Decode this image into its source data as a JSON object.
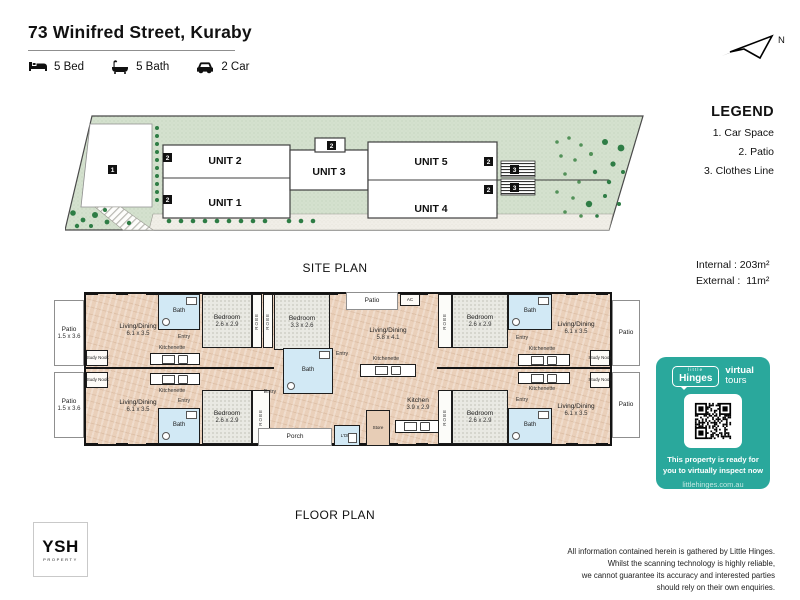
{
  "header": {
    "title": "73 Winifred Street, Kuraby",
    "features": [
      {
        "icon": "bed-icon",
        "label": "5 Bed"
      },
      {
        "icon": "bath-icon",
        "label": "5 Bath"
      },
      {
        "icon": "car-icon",
        "label": "2 Car"
      }
    ]
  },
  "compass": {
    "label": "N"
  },
  "legend": {
    "title": "LEGEND",
    "items": [
      "1. Car Space",
      "2. Patio",
      "3. Clothes Line"
    ]
  },
  "site_plan": {
    "caption": "SITE PLAN",
    "units": [
      {
        "name": "UNIT 2",
        "x": 160,
        "y": 52
      },
      {
        "name": "UNIT 1",
        "x": 160,
        "y": 94
      },
      {
        "name": "UNIT 3",
        "x": 264,
        "y": 63
      },
      {
        "name": "UNIT 5",
        "x": 366,
        "y": 53
      },
      {
        "name": "UNIT 4",
        "x": 366,
        "y": 100
      }
    ],
    "markers": [
      {
        "n": "1",
        "x": 43,
        "y": 53
      },
      {
        "n": "2",
        "x": 98,
        "y": 41
      },
      {
        "n": "2",
        "x": 98,
        "y": 83
      },
      {
        "n": "2",
        "x": 262,
        "y": 29
      },
      {
        "n": "2",
        "x": 419,
        "y": 45
      },
      {
        "n": "2",
        "x": 419,
        "y": 73
      },
      {
        "n": "3",
        "x": 445,
        "y": 53
      },
      {
        "n": "3",
        "x": 445,
        "y": 71
      }
    ]
  },
  "areas": {
    "lines": [
      "Internal : 203m²",
      "External :  11m²"
    ]
  },
  "floor_plan": {
    "caption": "FLOOR PLAN",
    "rooms": [
      {
        "id": "patio-top-left",
        "label": "Patio",
        "dims": "1.5 x 3.6",
        "type": "white",
        "x": 2,
        "y": 8,
        "w": 30,
        "h": 66
      },
      {
        "id": "patio-bottom-left",
        "label": "Patio",
        "dims": "1.5 x 3.6",
        "type": "white",
        "x": 2,
        "y": 80,
        "w": 30,
        "h": 66
      },
      {
        "id": "living-top-left",
        "label": "Living/Dining",
        "dims": "6.1 x 3.5",
        "type": "label",
        "lx": 86,
        "ly": 38
      },
      {
        "id": "living-bottom-left",
        "label": "Living/Dining",
        "dims": "6.1 x 3.5",
        "type": "label",
        "lx": 86,
        "ly": 114
      },
      {
        "id": "study-nook-top-left",
        "label": "Study Nook",
        "type": "nook",
        "x": 34,
        "y": 58,
        "w": 22,
        "h": 16
      },
      {
        "id": "study-nook-bottom-left",
        "label": "Study Nook",
        "type": "nook",
        "x": 34,
        "y": 80,
        "w": 22,
        "h": 16
      },
      {
        "id": "kitchenette-top-left",
        "label": "Kitchenette",
        "type": "label",
        "s": 1,
        "lx": 120,
        "ly": 56
      },
      {
        "id": "kitchenette-bottom-left",
        "label": "Kitchenette",
        "type": "label",
        "s": 1,
        "lx": 120,
        "ly": 99
      },
      {
        "id": "kitchenette-units-top-left",
        "type": "kitrow",
        "x": 98,
        "y": 61,
        "w": 50,
        "h": 12
      },
      {
        "id": "kitchenette-units-bottom-left",
        "type": "kitrow",
        "x": 98,
        "y": 81,
        "w": 50,
        "h": 12
      },
      {
        "id": "bath-top-left",
        "label": "Bath",
        "type": "bath",
        "x": 106,
        "y": 2,
        "w": 42,
        "h": 36
      },
      {
        "id": "bath-bottom-left",
        "label": "Bath",
        "type": "bath",
        "x": 106,
        "y": 116,
        "w": 42,
        "h": 36
      },
      {
        "id": "entry-top-left",
        "label": "Entry",
        "type": "label",
        "s": 1,
        "lx": 132,
        "ly": 45
      },
      {
        "id": "entry-bottom-left",
        "label": "Entry",
        "type": "label",
        "s": 1,
        "lx": 132,
        "ly": 109
      },
      {
        "id": "bedroom-top-left",
        "label": "Bedroom",
        "dims": "2.6 x 2.9",
        "type": "carpet",
        "x": 150,
        "y": 2,
        "w": 50,
        "h": 54
      },
      {
        "id": "bedroom-bottom-left",
        "label": "Bedroom",
        "dims": "2.6 x 2.9",
        "type": "carpet",
        "x": 150,
        "y": 98,
        "w": 50,
        "h": 54
      },
      {
        "id": "robe-1-top-left",
        "label": "ROBE",
        "type": "robe",
        "x": 200,
        "y": 2,
        "w": 10,
        "h": 54
      },
      {
        "id": "robe-2-top-left",
        "label": "ROBE",
        "type": "robe",
        "x": 211,
        "y": 2,
        "w": 10,
        "h": 54
      },
      {
        "id": "robe-bottom-left",
        "label": "ROBE",
        "type": "robe",
        "x": 200,
        "y": 98,
        "w": 18,
        "h": 54
      },
      {
        "id": "bedroom-top-middle",
        "label": "Bedroom",
        "dims": "3.3 x 2.6",
        "type": "carpet",
        "x": 222,
        "y": 2,
        "w": 56,
        "h": 56
      },
      {
        "id": "bath-middle",
        "label": "Bath",
        "type": "bath",
        "x": 231,
        "y": 56,
        "w": 50,
        "h": 46
      },
      {
        "id": "entry-middle-top",
        "label": "Entry",
        "type": "label",
        "s": 1,
        "lx": 290,
        "ly": 62
      },
      {
        "id": "entry-middle-bottom",
        "label": "Entry",
        "type": "label",
        "s": 1,
        "lx": 218,
        "ly": 100
      },
      {
        "id": "porch",
        "label": "Porch",
        "type": "white",
        "x": 206,
        "y": 136,
        "w": 74,
        "h": 18
      },
      {
        "id": "laundry",
        "label": "L'DRY",
        "type": "bathsm",
        "x": 282,
        "y": 133,
        "w": 26,
        "h": 21
      },
      {
        "id": "store",
        "label": "Store",
        "type": "store",
        "x": 314,
        "y": 118,
        "w": 24,
        "h": 36
      },
      {
        "id": "patio-middle",
        "label": "Patio",
        "type": "white",
        "x": 294,
        "y": 0,
        "w": 52,
        "h": 18
      },
      {
        "id": "ac-unit",
        "label": "AC",
        "type": "nook",
        "x": 348,
        "y": 2,
        "w": 20,
        "h": 12
      },
      {
        "id": "living-middle",
        "label": "Living/Dining",
        "dims": "5.8 x 4.1",
        "type": "label",
        "lx": 336,
        "ly": 42
      },
      {
        "id": "kitchenette-middle",
        "label": "Kitchenette",
        "type": "label",
        "s": 1,
        "lx": 334,
        "ly": 67
      },
      {
        "id": "kitchenette-units-middle",
        "type": "kitrow",
        "x": 308,
        "y": 72,
        "w": 56,
        "h": 13
      },
      {
        "id": "kitchen-middle",
        "label": "Kitchen",
        "dims": "3.9 x 2.9",
        "type": "label",
        "lx": 366,
        "ly": 112
      },
      {
        "id": "kitchen-units-middle",
        "type": "kitrow",
        "x": 343,
        "y": 128,
        "w": 44,
        "h": 13
      },
      {
        "id": "robe-top-right",
        "label": "ROBE",
        "type": "robe",
        "x": 386,
        "y": 2,
        "w": 14,
        "h": 54
      },
      {
        "id": "robe-bottom-right",
        "label": "ROBE",
        "type": "robe",
        "x": 386,
        "y": 98,
        "w": 14,
        "h": 54
      },
      {
        "id": "bedroom-top-right",
        "label": "Bedroom",
        "dims": "2.6 x 2.9",
        "type": "carpet",
        "x": 400,
        "y": 2,
        "w": 56,
        "h": 54
      },
      {
        "id": "bedroom-bottom-right",
        "label": "Bedroom",
        "dims": "2.6 x 2.9",
        "type": "carpet",
        "x": 400,
        "y": 98,
        "w": 56,
        "h": 54
      },
      {
        "id": "bath-top-right",
        "label": "Bath",
        "type": "bath",
        "x": 456,
        "y": 2,
        "w": 44,
        "h": 36
      },
      {
        "id": "bath-bottom-right",
        "label": "Bath",
        "type": "bath",
        "x": 456,
        "y": 116,
        "w": 44,
        "h": 36
      },
      {
        "id": "entry-top-right",
        "label": "Entry",
        "type": "label",
        "s": 1,
        "lx": 470,
        "ly": 46
      },
      {
        "id": "entry-bottom-right",
        "label": "Entry",
        "type": "label",
        "s": 1,
        "lx": 470,
        "ly": 108
      },
      {
        "id": "kitchenette-top-right",
        "label": "Kitchenette",
        "type": "label",
        "s": 1,
        "lx": 490,
        "ly": 57
      },
      {
        "id": "kitchenette-bottom-right",
        "label": "Kitchenette",
        "type": "label",
        "s": 1,
        "lx": 490,
        "ly": 97
      },
      {
        "id": "kitchenette-units-top-right",
        "type": "kitrow",
        "x": 466,
        "y": 62,
        "w": 52,
        "h": 12
      },
      {
        "id": "kitchenette-units-bottom-right",
        "type": "kitrow",
        "x": 466,
        "y": 80,
        "w": 52,
        "h": 12
      },
      {
        "id": "living-top-right",
        "label": "Living/Dining",
        "dims": "6.1 x 3.5",
        "type": "label",
        "lx": 524,
        "ly": 36
      },
      {
        "id": "living-bottom-right",
        "label": "Living/Dining",
        "dims": "6.1 x 3.5",
        "type": "label",
        "lx": 524,
        "ly": 118
      },
      {
        "id": "study-nook-top-right",
        "label": "Study Nook",
        "type": "nook",
        "x": 538,
        "y": 58,
        "w": 20,
        "h": 16
      },
      {
        "id": "study-nook-bottom-right",
        "label": "Study Nook",
        "type": "nook",
        "x": 538,
        "y": 80,
        "w": 20,
        "h": 16
      },
      {
        "id": "patio-top-right",
        "label": "Patio",
        "type": "white",
        "x": 560,
        "y": 8,
        "w": 28,
        "h": 66
      },
      {
        "id": "patio-bottom-right",
        "label": "Patio",
        "type": "white",
        "x": 560,
        "y": 80,
        "w": 28,
        "h": 66
      }
    ]
  },
  "promo_card": {
    "brand_small": "little",
    "brand_name": "Hinges",
    "product_bold": "virtual",
    "product_light": "tours",
    "message": "This property is ready for\nyou to virtually inspect now",
    "url": "littlehinges.com.au",
    "color": "#2aa89c"
  },
  "footer": {
    "logo_name": "YSH",
    "logo_sub": "PROPERTY",
    "disclaimer": [
      "All information contained herein is gathered by Little Hinges.",
      "Whilst the scanning technology is highly reliable,",
      "we cannot guarantee its accuracy and interested parties",
      "should rely on their own enquiries."
    ]
  }
}
